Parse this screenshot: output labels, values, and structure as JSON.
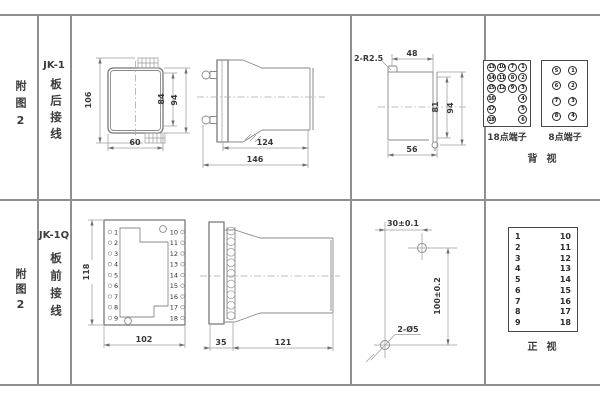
{
  "palette": {
    "background": "#ffffff",
    "grid_line": "#8f8f8f",
    "drawing_line": "#787878",
    "dimension_line": "#9c9c9c",
    "text": "#3a3a3a"
  },
  "top_section": {
    "figure_label": "附图2",
    "model": "JK-1",
    "wiring_label": "板后接线",
    "front_view": {
      "dim_height_overall": "106",
      "dim_height_inner": "84",
      "dim_height_outer": "94",
      "dim_width": "60"
    },
    "side_view": {
      "dim_body_length": "124",
      "dim_overall_length": "146"
    },
    "cutout_view": {
      "corner_radius": "2-R2.5",
      "dim_width_top": "48",
      "dim_height_inner": "81",
      "dim_height_outer": "94",
      "dim_width_bottom": "56"
    },
    "terminal_18": {
      "label": "18点端子",
      "rows": [
        [
          "13",
          "10",
          "7",
          "1"
        ],
        [
          "14",
          "11",
          "8",
          "2"
        ],
        [
          "15",
          "12",
          "9",
          "3"
        ],
        [
          "16",
          "",
          "",
          "4"
        ],
        [
          "17",
          "",
          "",
          "5"
        ],
        [
          "18",
          "",
          "",
          "6"
        ]
      ]
    },
    "terminal_8": {
      "label": "8点端子",
      "rows": [
        [
          "5",
          "1"
        ],
        [
          "6",
          "2"
        ],
        [
          "7",
          "3"
        ],
        [
          "8",
          "4"
        ]
      ]
    },
    "view_label": "背视"
  },
  "bottom_section": {
    "figure_label": "附图2",
    "model": "JK-1Q",
    "wiring_label": "板前接线",
    "front_view": {
      "dim_height": "118",
      "dim_width": "102",
      "left_terminals": [
        "1",
        "2",
        "3",
        "4",
        "5",
        "6",
        "7",
        "8",
        "9"
      ],
      "right_terminals": [
        "10",
        "11",
        "12",
        "13",
        "14",
        "15",
        "16",
        "17",
        "18"
      ]
    },
    "side_view": {
      "dim_plate": "35",
      "dim_body": "121"
    },
    "drill_view": {
      "dim_width": "30±0.1",
      "dim_height": "100±0.2",
      "hole_label": "2-Ø5"
    },
    "terminal_table": {
      "left": [
        "1",
        "2",
        "3",
        "4",
        "5",
        "6",
        "7",
        "8",
        "9"
      ],
      "right": [
        "10",
        "11",
        "12",
        "13",
        "14",
        "15",
        "16",
        "17",
        "18"
      ],
      "view_label": "正视"
    }
  }
}
